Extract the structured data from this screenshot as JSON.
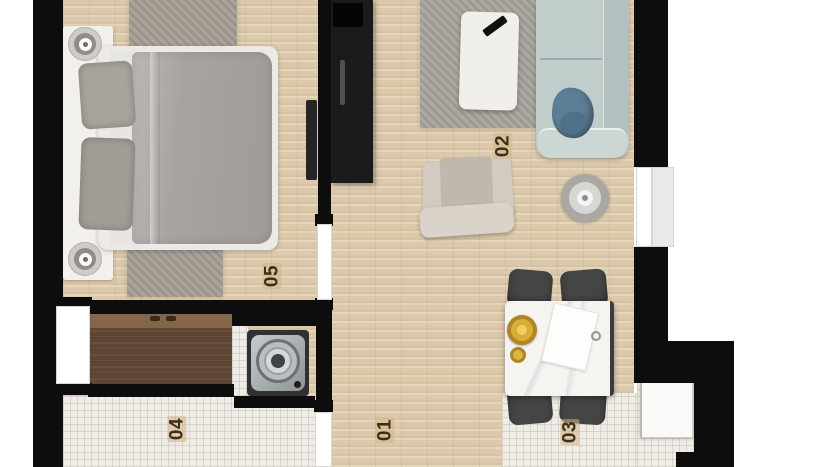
{
  "plan": {
    "type": "apartment-floor-plan-top-view",
    "room_labels": [
      {
        "text": "01",
        "room": "hallway-living-area"
      },
      {
        "text": "02",
        "room": "living-room"
      },
      {
        "text": "03",
        "room": "kitchen-dining"
      },
      {
        "text": "04",
        "room": "bathroom"
      },
      {
        "text": "05",
        "room": "bedroom"
      }
    ],
    "colors": {
      "wall": "#0d0d0d",
      "wood_floor": "#dcc9ab",
      "tile_floor": "#efece7",
      "closet_wood": "#5f4533",
      "rug_gray": "#a29c92",
      "sofa_blue": "#c0cdca",
      "sofa_pillow_blue": "#5d7f96",
      "gold_plate": "#c89b2e",
      "armchair_cream": "#d2cbc1",
      "bedding_gray": "#a7a29e",
      "tv_unit_black": "#1b1b1b",
      "label_text": "#3e2d1b"
    }
  }
}
